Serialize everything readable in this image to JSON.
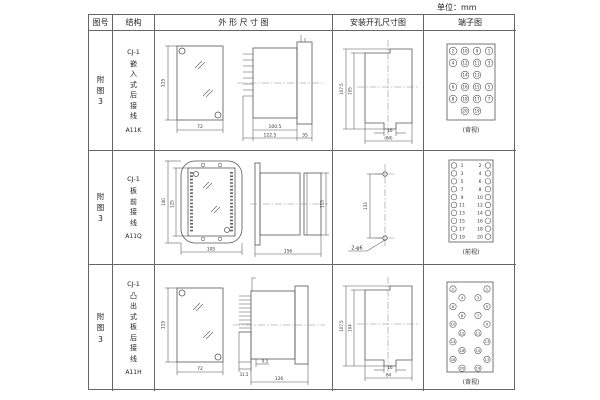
{
  "unit_label": "单位：mm",
  "table": {
    "headers": {
      "fig": "图号",
      "structure": "结构",
      "outline": "外 形 尺 寸 图",
      "mounting": "安装开孔尺寸图",
      "terminal": "端子图"
    }
  },
  "rows": [
    {
      "fig": "附图3",
      "model": "CJ-1",
      "desc": "嵌入式后接线",
      "code": "A11K",
      "outline": {
        "front_height": "115",
        "front_width": "72",
        "body_len": "100.5",
        "total_len": "122.5",
        "flange_depth": "35"
      },
      "mounting": {
        "outer_h": "107.5",
        "inner_h": "105",
        "tab_w": "16",
        "cutout_w": "(64)"
      },
      "terminal": {
        "type": "grid4",
        "view": "(背视)",
        "pins": [
          [
            "2",
            "10",
            "9",
            "1"
          ],
          [
            "4",
            "12",
            "11",
            "3"
          ],
          [
            "",
            "14",
            "13",
            ""
          ],
          [
            "6",
            "16",
            "15",
            "5"
          ],
          [
            "8",
            "18",
            "17",
            "7"
          ],
          [
            "",
            "20",
            "19",
            ""
          ]
        ]
      }
    },
    {
      "fig": "附图3",
      "model": "CJ-1",
      "desc": "板前接线",
      "code": "A11Q",
      "outline": {
        "front_outer_h": "140",
        "front_inner_h": "125",
        "front_w": "105",
        "side_len": "156",
        "side_h": "115"
      },
      "mounting": {
        "hole_dist": "133",
        "hole_label": "2-φ6"
      },
      "terminal": {
        "type": "pairs",
        "view": "(前视)",
        "pins": [
          [
            "1",
            "2"
          ],
          [
            "3",
            "4"
          ],
          [
            "5",
            "6"
          ],
          [
            "7",
            "8"
          ],
          [
            "9",
            "10"
          ],
          [
            "11",
            "12"
          ],
          [
            "13",
            "14"
          ],
          [
            "15",
            "16"
          ],
          [
            "17",
            "18"
          ],
          [
            "19",
            "20"
          ]
        ]
      }
    },
    {
      "fig": "附图3",
      "model": "CJ-1",
      "desc": "凸出式板后接线",
      "code": "A11H",
      "outline": {
        "front_height": "115",
        "front_width": "72",
        "comb_depth": "31.5",
        "gap": "9.5",
        "body_len": "126"
      },
      "mounting": {
        "outer_h": "107.5",
        "inner_h": "104",
        "tab_w": "16",
        "cutout_w": "64"
      },
      "terminal": {
        "type": "zigzag",
        "view": "(背视)",
        "pins": [
          [
            "2",
            "1"
          ],
          [
            "4",
            "3"
          ],
          [
            "6",
            "5"
          ],
          [
            "8",
            "7"
          ],
          [
            "10",
            "9"
          ],
          [
            "12",
            "11"
          ],
          [
            "14",
            "13"
          ],
          [
            "16",
            "15"
          ],
          [
            "18",
            "17"
          ],
          [
            "20",
            "19"
          ]
        ]
      }
    }
  ]
}
